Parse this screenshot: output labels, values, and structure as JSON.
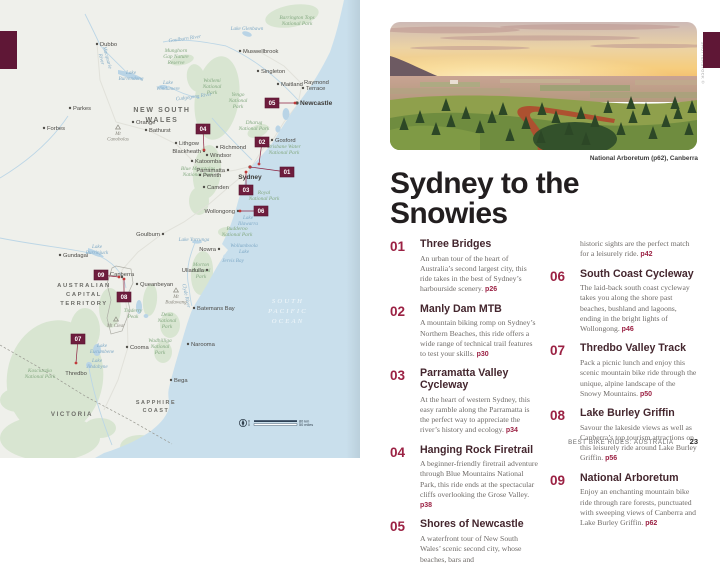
{
  "colors": {
    "accent_maroon": "#9b2143",
    "tab_maroon": "#5f1736",
    "marker_maroon": "#6e1d3d",
    "ocean": "#c9dfec",
    "land": "#eff0eb",
    "park_green": "#d8e5d1",
    "water_blue": "#b9d4e6"
  },
  "title": "Sydney to the Snowies",
  "photo": {
    "caption": "National Arboretum (p62), Canberra",
    "credit": "SHUTTERSTOCK ©"
  },
  "footer": {
    "book_title": "BEST BIKE RIDES: AUSTRALIA",
    "page_number": "23"
  },
  "rides": [
    {
      "num": "01",
      "name": "Three Bridges",
      "desc": "An urban tour of the heart of Australia’s second largest city, this ride takes in the best of Sydney’s harbourside scenery.",
      "page": "p26",
      "col": 1
    },
    {
      "num": "02",
      "name": "Manly Dam MTB",
      "desc": "A mountain biking romp on Sydney’s Northern Beaches, this ride offers a wide range of technical trail features to test your skills.",
      "page": "p30",
      "col": 1
    },
    {
      "num": "03",
      "name": "Parramatta Valley Cycleway",
      "desc": "At the heart of western Sydney, this easy ramble along the Parramatta is the perfect way to appreciate the river’s history and ecology.",
      "page": "p34",
      "col": 1
    },
    {
      "num": "04",
      "name": "Hanging Rock Firetrail",
      "desc": "A beginner-friendly firetrail adventure through Blue Mountains National Park, this ride ends at the spectacular cliffs overlooking the Grose Valley.",
      "page": "p38",
      "col": 1
    },
    {
      "num": "05",
      "name": "Shores of Newcastle",
      "desc": "A waterfront tour of New South Wales’ scenic second city, whose beaches, bars and",
      "desc_cont": "historic sights are the perfect match for a leisurely ride.",
      "page": "p42",
      "col": 1
    },
    {
      "num": "06",
      "name": "South Coast Cycleway",
      "desc": "The laid-back south coast cycleway takes you along the shore past beaches, bushland and lagoons, ending in the bright lights of Wollongong.",
      "page": "p46",
      "col": 2
    },
    {
      "num": "07",
      "name": "Thredbo Valley Track",
      "desc": "Pack a picnic lunch and enjoy this scenic mountain bike ride through the unique, alpine landscape of the Snowy Mountains.",
      "page": "p50",
      "col": 2
    },
    {
      "num": "08",
      "name": "Lake Burley Griffin",
      "desc": "Savour the lakeside views as well as Canberra’s top tourism attractions on this leisurely ride around Lake Burley Griffin.",
      "page": "p56",
      "col": 2
    },
    {
      "num": "09",
      "name": "National Arboretum",
      "desc": "Enjoy an enchanting mountain bike ride through rare forests, punctuated with sweeping views of Canberra and Lake Burley Griffin.",
      "page": "p62",
      "col": 2
    }
  ],
  "map": {
    "regions": [
      {
        "lines": [
          "NEW SOUTH",
          "WALES"
        ],
        "x": 162,
        "y": 112,
        "cls": "t-region",
        "lh": 10
      },
      {
        "lines": [
          "AUSTRALIAN",
          "CAPITAL",
          "TERRITORY"
        ],
        "x": 84,
        "y": 287,
        "cls": "t-region",
        "size": 5.8,
        "lh": 9
      },
      {
        "lines": [
          "VICTORIA"
        ],
        "x": 72,
        "y": 416,
        "cls": "t-region",
        "size": 6.2,
        "lh": 9
      },
      {
        "lines": [
          "SAPPHIRE",
          "COAST"
        ],
        "x": 156,
        "y": 404,
        "cls": "t-region",
        "size": 5.4,
        "lh": 8
      },
      {
        "lines": [
          "SOUTH",
          "PACIFIC",
          "OCEAN"
        ],
        "x": 288,
        "y": 303,
        "cls": "t-ocean",
        "lh": 10
      }
    ],
    "parks_labels": [
      {
        "lines": [
          "Barrington Tops",
          "National Park"
        ],
        "x": 297,
        "y": 19
      },
      {
        "lines": [
          "Munghorn",
          "Gap Nature",
          "Reserve"
        ],
        "x": 176,
        "y": 52
      },
      {
        "lines": [
          "Wollemi",
          "National",
          "Park"
        ],
        "x": 212,
        "y": 82
      },
      {
        "lines": [
          "Yengo",
          "National",
          "Park"
        ],
        "x": 238,
        "y": 96
      },
      {
        "lines": [
          "Dharug",
          "National Park"
        ],
        "x": 254,
        "y": 124
      },
      {
        "lines": [
          "Brisbane Water",
          "National Park"
        ],
        "x": 284,
        "y": 148
      },
      {
        "lines": [
          "Blue Mountains",
          "National Park"
        ],
        "x": 198,
        "y": 170
      },
      {
        "lines": [
          "Royal",
          "National Park"
        ],
        "x": 264,
        "y": 194
      },
      {
        "lines": [
          "Budderoo",
          "National Park"
        ],
        "x": 237,
        "y": 230
      },
      {
        "lines": [
          "Morton",
          "National",
          "Park"
        ],
        "x": 201,
        "y": 266
      },
      {
        "lines": [
          "Deua",
          "National",
          "Park"
        ],
        "x": 167,
        "y": 316
      },
      {
        "lines": [
          "Wadbilliga",
          "National",
          "Park"
        ],
        "x": 160,
        "y": 342
      },
      {
        "lines": [
          "Kosciuszko",
          "National Park"
        ],
        "x": 40,
        "y": 372
      },
      {
        "lines": [
          "Tinderry",
          "Peak"
        ],
        "x": 133,
        "y": 312
      }
    ],
    "water_labels": [
      {
        "lines": [
          "Goulburn River"
        ],
        "x": 185,
        "y": 40,
        "rot": -8
      },
      {
        "lines": [
          "Macquarie",
          "River"
        ],
        "x": 106,
        "y": 58,
        "rot": 75
      },
      {
        "lines": [
          "Lake",
          "Burrendong"
        ],
        "x": 131,
        "y": 74
      },
      {
        "lines": [
          "Lake",
          "Windamere"
        ],
        "x": 168,
        "y": 84
      },
      {
        "lines": [
          "Cudgegong River"
        ],
        "x": 194,
        "y": 98,
        "rot": -8
      },
      {
        "lines": [
          "Lake Glenbawn"
        ],
        "x": 247,
        "y": 30
      },
      {
        "lines": [
          "Lake",
          "Illawarra"
        ],
        "x": 248,
        "y": 219
      },
      {
        "lines": [
          "Lake Yarrunga"
        ],
        "x": 194,
        "y": 241
      },
      {
        "lines": [
          "Wollumboola",
          "Lake"
        ],
        "x": 244,
        "y": 247
      },
      {
        "lines": [
          "Jervis Bay"
        ],
        "x": 233,
        "y": 262
      },
      {
        "lines": [
          "Lake",
          "Burrinjuck"
        ],
        "x": 97,
        "y": 248
      },
      {
        "lines": [
          "Lake",
          "Eucumbene"
        ],
        "x": 102,
        "y": 347
      },
      {
        "lines": [
          "Lake",
          "Jindabyne"
        ],
        "x": 97,
        "y": 362
      },
      {
        "lines": [
          "Clyde River"
        ],
        "x": 185,
        "y": 296,
        "rot": 78
      }
    ],
    "towns": [
      {
        "name": "Dubbo",
        "x": 97,
        "y": 44
      },
      {
        "name": "Muswellbrook",
        "x": 240,
        "y": 51
      },
      {
        "name": "Singleton",
        "x": 258,
        "y": 71
      },
      {
        "name": "Maitland",
        "x": 278,
        "y": 84
      },
      {
        "name": "Raymond",
        "x": 301,
        "y": 82,
        "nodot": true
      },
      {
        "name": "Terrace",
        "x": 303,
        "y": 88
      },
      {
        "name": "Newcastle",
        "x": 297,
        "y": 103,
        "city": true
      },
      {
        "name": "Gosford",
        "x": 272,
        "y": 140
      },
      {
        "name": "Richmond",
        "x": 217,
        "y": 147
      },
      {
        "name": "Windsor",
        "x": 207,
        "y": 155
      },
      {
        "name": "Penrith",
        "x": 200,
        "y": 175
      },
      {
        "name": "Parramatta",
        "x": 228,
        "y": 170,
        "end": true
      },
      {
        "name": "Sydney",
        "x": 250,
        "y": 167,
        "city": true,
        "dy": 10
      },
      {
        "name": "Camden",
        "x": 204,
        "y": 187
      },
      {
        "name": "Wollongong",
        "x": 238,
        "y": 211,
        "end": true
      },
      {
        "name": "Nowra",
        "x": 219,
        "y": 249,
        "end": true
      },
      {
        "name": "Ulladulla",
        "x": 207,
        "y": 270,
        "end": true
      },
      {
        "name": "Goulburn",
        "x": 163,
        "y": 234,
        "end": true
      },
      {
        "name": "Gundagai",
        "x": 60,
        "y": 255
      },
      {
        "name": "Canberra",
        "x": 122,
        "y": 277,
        "dy": -3
      },
      {
        "name": "Queanbeyan",
        "x": 137,
        "y": 284
      },
      {
        "name": "Cooma",
        "x": 127,
        "y": 347
      },
      {
        "name": "Thredbo",
        "x": 76,
        "y": 365,
        "dy": 8,
        "nodot": true
      },
      {
        "name": "Orange",
        "x": 133,
        "y": 122
      },
      {
        "name": "Bathurst",
        "x": 146,
        "y": 130
      },
      {
        "name": "Lithgow",
        "x": 176,
        "y": 143
      },
      {
        "name": "Blackheath",
        "x": 204,
        "y": 151,
        "end": true
      },
      {
        "name": "Katoomba",
        "x": 192,
        "y": 161
      },
      {
        "name": "Parkes",
        "x": 70,
        "y": 108
      },
      {
        "name": "Forbes",
        "x": 44,
        "y": 128
      },
      {
        "name": "Batemans Bay",
        "x": 194,
        "y": 308
      },
      {
        "name": "Narooma",
        "x": 188,
        "y": 344
      },
      {
        "name": "Bega",
        "x": 171,
        "y": 380
      }
    ],
    "mountains": [
      {
        "lines": [
          "Mt",
          "Canobolas"
        ],
        "x": 118,
        "y": 128
      },
      {
        "lines": [
          "Mt",
          "Budawang"
        ],
        "x": 176,
        "y": 291
      },
      {
        "lines": [
          "Mt Clear"
        ],
        "x": 116,
        "y": 320
      }
    ],
    "markers": [
      {
        "num": "01",
        "bx": 287,
        "by": 172,
        "tx": 250,
        "ty": 167
      },
      {
        "num": "02",
        "bx": 262,
        "by": 142,
        "tx": 259,
        "ty": 164
      },
      {
        "num": "03",
        "bx": 246,
        "by": 190,
        "tx": 246,
        "ty": 172
      },
      {
        "num": "04",
        "bx": 203,
        "by": 129,
        "tx": 204,
        "ty": 150
      },
      {
        "num": "05",
        "bx": 272,
        "by": 103,
        "tx": 295,
        "ty": 103
      },
      {
        "num": "06",
        "bx": 261,
        "by": 211,
        "tx": 240,
        "ty": 211
      },
      {
        "num": "07",
        "bx": 78,
        "by": 339,
        "tx": 76,
        "ty": 363
      },
      {
        "num": "08",
        "bx": 124,
        "by": 297,
        "tx": 124,
        "ty": 279
      },
      {
        "num": "09",
        "bx": 101,
        "by": 275,
        "tx": 119,
        "ty": 277
      }
    ],
    "scale": {
      "zero": "0",
      "top_label": "80 km",
      "bottom_label": "50 miles"
    }
  }
}
